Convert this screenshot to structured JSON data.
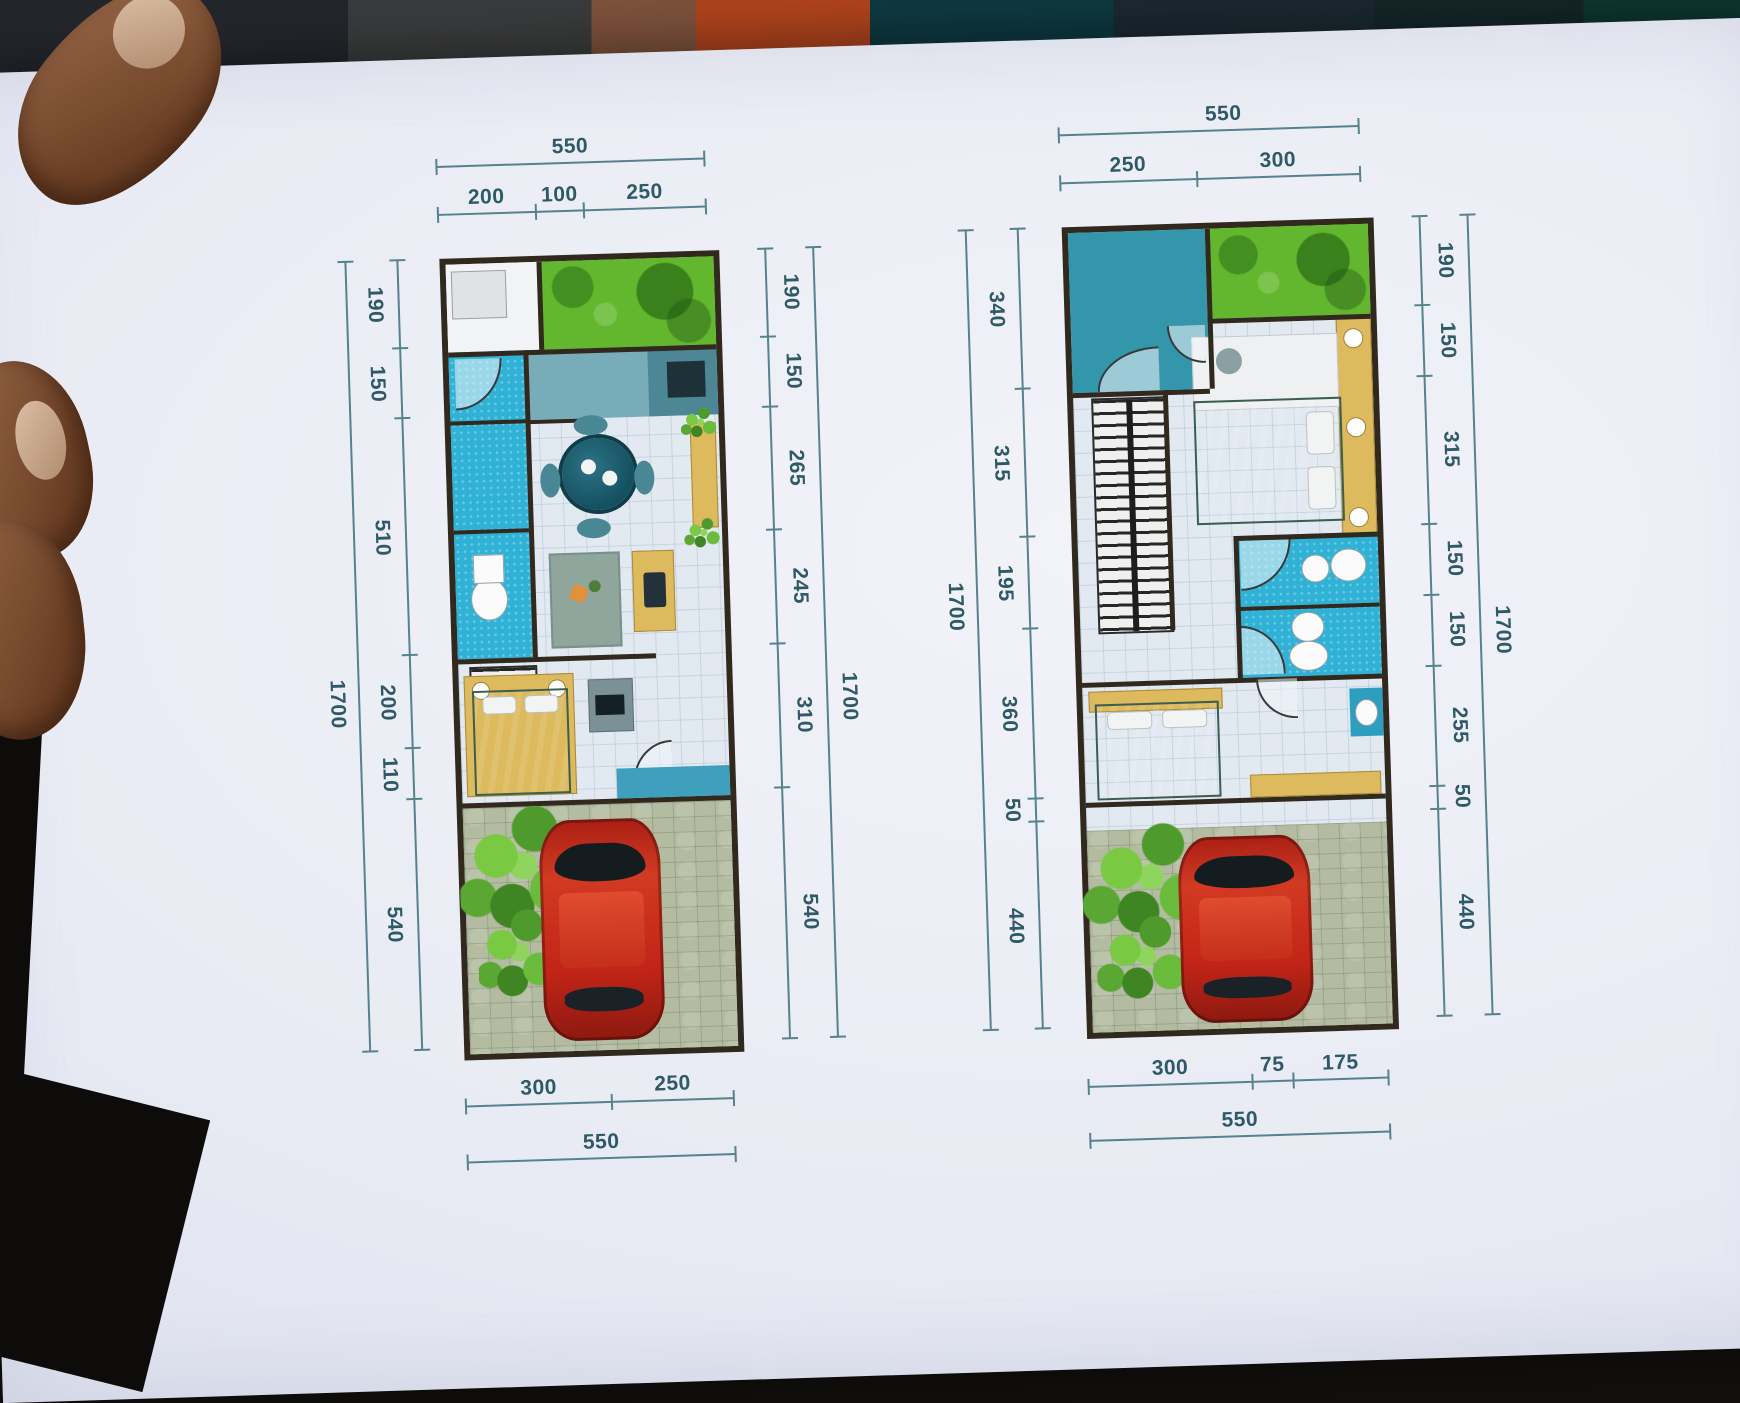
{
  "photo": {
    "description": "hand holding a printed two-storey house floor plan",
    "palette": {
      "paper": "#e9ebf4",
      "dimension_text": "#2d5a66",
      "dimension_line": "#56828d",
      "wall": "#31281e",
      "lawn_green": "#63b72e",
      "bath_blue": "#2fb2d6",
      "furniture_yellow": "#ddba5e",
      "bed_green": "#4e7563",
      "car_red": "#c22517",
      "paving": "#b3bca1"
    }
  },
  "plans": [
    {
      "name": "ground-floor-plan",
      "top": {
        "total": "550",
        "segments": [
          "200",
          "100",
          "250"
        ]
      },
      "left": {
        "total": "1700",
        "segments": [
          "190",
          "150",
          "510",
          "200",
          "110",
          "540"
        ]
      },
      "right": {
        "total": "1700",
        "segments": [
          "190",
          "150",
          "265",
          "245",
          "310",
          "540"
        ]
      },
      "bottom": {
        "total": "550",
        "segments": [
          "300",
          "250"
        ]
      }
    },
    {
      "name": "upper-floor-plan",
      "top": {
        "total": "550",
        "segments": [
          "250",
          "300"
        ]
      },
      "left": {
        "total": "1700",
        "segments": [
          "340",
          "315",
          "195",
          "360",
          "50",
          "440"
        ]
      },
      "right": {
        "total": "1700",
        "segments": [
          "190",
          "150",
          "315",
          "150",
          "150",
          "255",
          "50",
          "440"
        ]
      },
      "bottom": {
        "total": "550",
        "segments": [
          "300",
          "75",
          "175"
        ]
      }
    }
  ]
}
